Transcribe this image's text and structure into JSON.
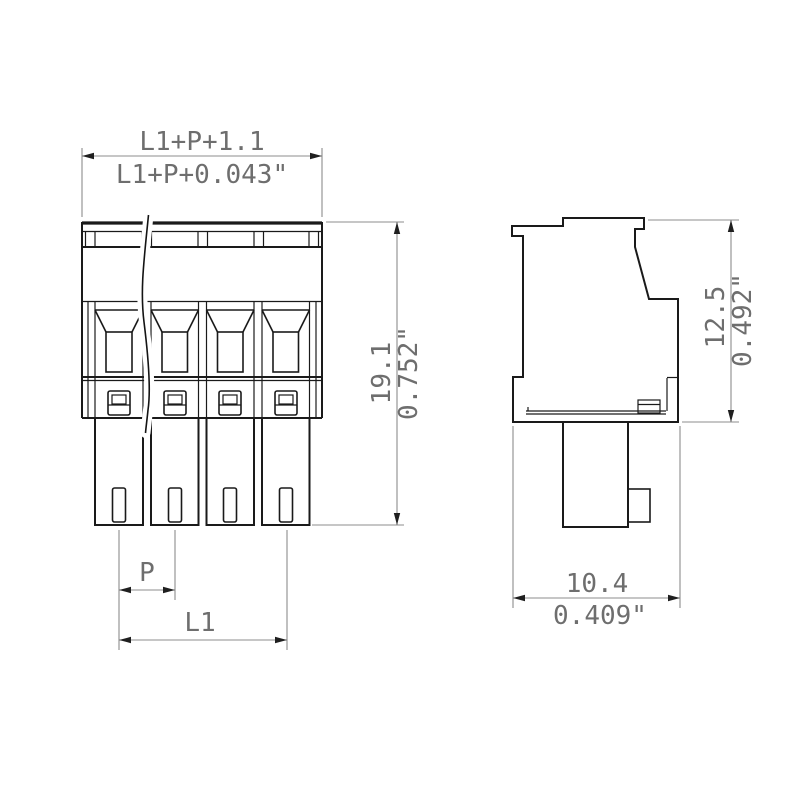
{
  "colors": {
    "outline": "#1a1a1a",
    "dimension_line": "#8c8c8c",
    "label": "#6e6e6e",
    "background": "#ffffff"
  },
  "front_view": {
    "total_width_mm": "L1+P+1.1",
    "total_width_inch": "L1+P+0.043\"",
    "height_mm": "19.1",
    "height_inch": "0.752\"",
    "pitch_label": "P",
    "length_label": "L1"
  },
  "side_view": {
    "height_mm": "12.5",
    "height_inch": "0.492\"",
    "depth_mm": "10.4",
    "depth_inch": "0.409\""
  }
}
